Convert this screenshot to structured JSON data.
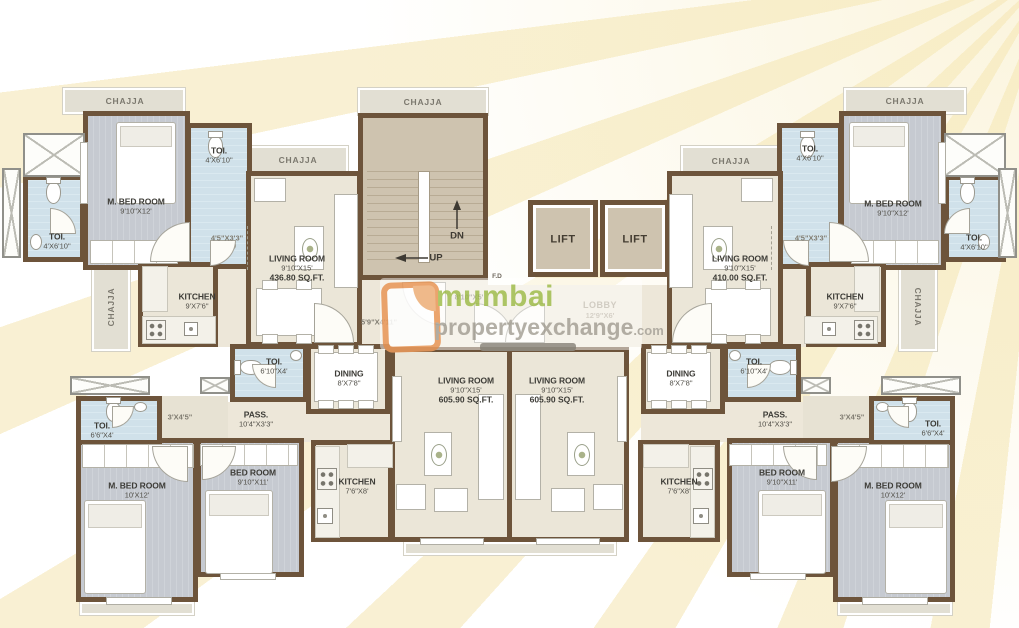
{
  "plan": {
    "chajja": "CHAJJA",
    "fd": "F.D",
    "stairs": {
      "up": "UP",
      "dn": "DN"
    },
    "lift": "LIFT",
    "lobby": {
      "name": "LOBBY",
      "dims": "12'9\"X6'"
    },
    "pass_corridor": "8'10\"X5'",
    "pass_stair_side": "5'9\"X4'11\"",
    "pass_45x33": "4'5\"X3'3\"",
    "pass_3x45": "3'X4'5\"",
    "mbed_top": {
      "name": "M. BED ROOM",
      "dims": "9'10\"X12'"
    },
    "mbed_bottom": {
      "name": "M. BED ROOM",
      "dims": "10'X12'"
    },
    "bed_bottom": {
      "name": "BED ROOM",
      "dims": "9'10\"X11'"
    },
    "toi_4x610": {
      "name": "TOI.",
      "dims": "4'X6'10\""
    },
    "toi_610x4": {
      "name": "TOI.",
      "dims": "6'10\"X4'"
    },
    "toi_66x4": {
      "name": "TOI.",
      "dims": "6'6\"X4'"
    },
    "living_436": {
      "name": "LIVING ROOM",
      "dims": "9'10\"X15'",
      "area": "436.80 SQ.FT."
    },
    "living_410": {
      "name": "LIVING ROOM",
      "dims": "9'10\"X15'",
      "area": "410.00 SQ.FT."
    },
    "living_605": {
      "name": "LIVING ROOM",
      "dims": "9'10\"X15'",
      "area": "605.90 SQ.FT."
    },
    "kitchen_top": {
      "name": "KITCHEN",
      "dims": "9'X7'6\""
    },
    "kitchen_bottom": {
      "name": "KITCHEN",
      "dims": "7'6\"X8'"
    },
    "dining": {
      "name": "DINING",
      "dims": "8'X7'8\""
    },
    "pass_bottom": {
      "name": "PASS.",
      "dims": "10'4\"X3'3\""
    }
  },
  "watermark": {
    "brand_green": "mumbai",
    "brand_gray": "propertyexchange",
    "brand_tld": ".com"
  },
  "colors": {
    "wall": "#6d543b",
    "bedroom_floor": "#c9cdd3",
    "toilet_floor": "#d3e3eb",
    "room_floor": "#ebe6d8",
    "stair_fill": "#cec3af",
    "chajja_fill": "#e2dfd3",
    "brand_green": "#a4c054",
    "brand_gray": "#a9a59b",
    "logo_orange": "#e9995b"
  }
}
